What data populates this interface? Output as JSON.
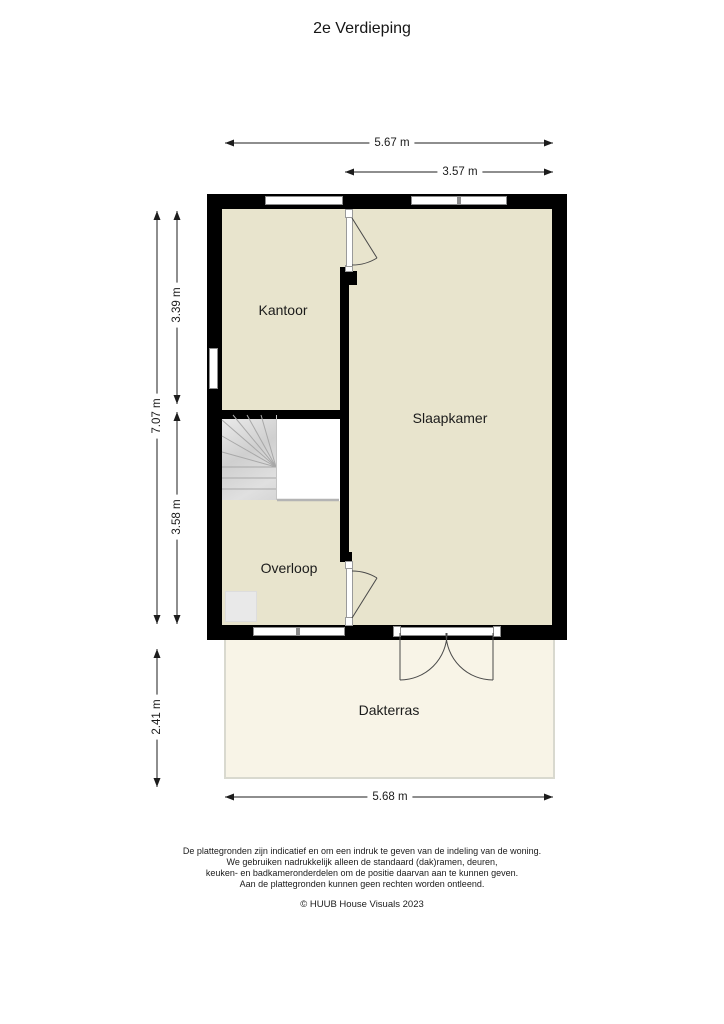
{
  "title": "2e Verdieping",
  "rooms": {
    "kantoor": {
      "label": "Kantoor"
    },
    "slaapkamer": {
      "label": "Slaapkamer"
    },
    "overloop": {
      "label": "Overloop"
    },
    "dakterras": {
      "label": "Dakterras"
    }
  },
  "dimensions": {
    "total_width": "5.67 m",
    "bedroom_width": "3.57 m",
    "total_depth": "7.07 m",
    "kantoor_depth": "3.39 m",
    "overloop_depth": "3.58 m",
    "terrace_depth": "2.41 m",
    "terrace_width": "5.68 m"
  },
  "footer": {
    "disclaimer_lines": [
      "De plattegronden zijn indicatief en om een indruk te geven van de indeling van de woning.",
      "We gebruiken nadrukkelijk alleen de standaard (dak)ramen, deuren,",
      "keuken- en badkameronderdelen om de positie daarvan aan te kunnen geven.",
      "Aan de plattegronden kunnen geen rechten worden ontleend."
    ],
    "copyright": "© HUUB House Visuals 2023"
  },
  "colors": {
    "wall": "#000000",
    "room_fill": "#e8e4cd",
    "terrace_fill": "#f8f4e7",
    "window_frame": "#8c8c8c",
    "stair_fill": "#d9d9d9",
    "dimension_line": "#1c1c1c"
  }
}
